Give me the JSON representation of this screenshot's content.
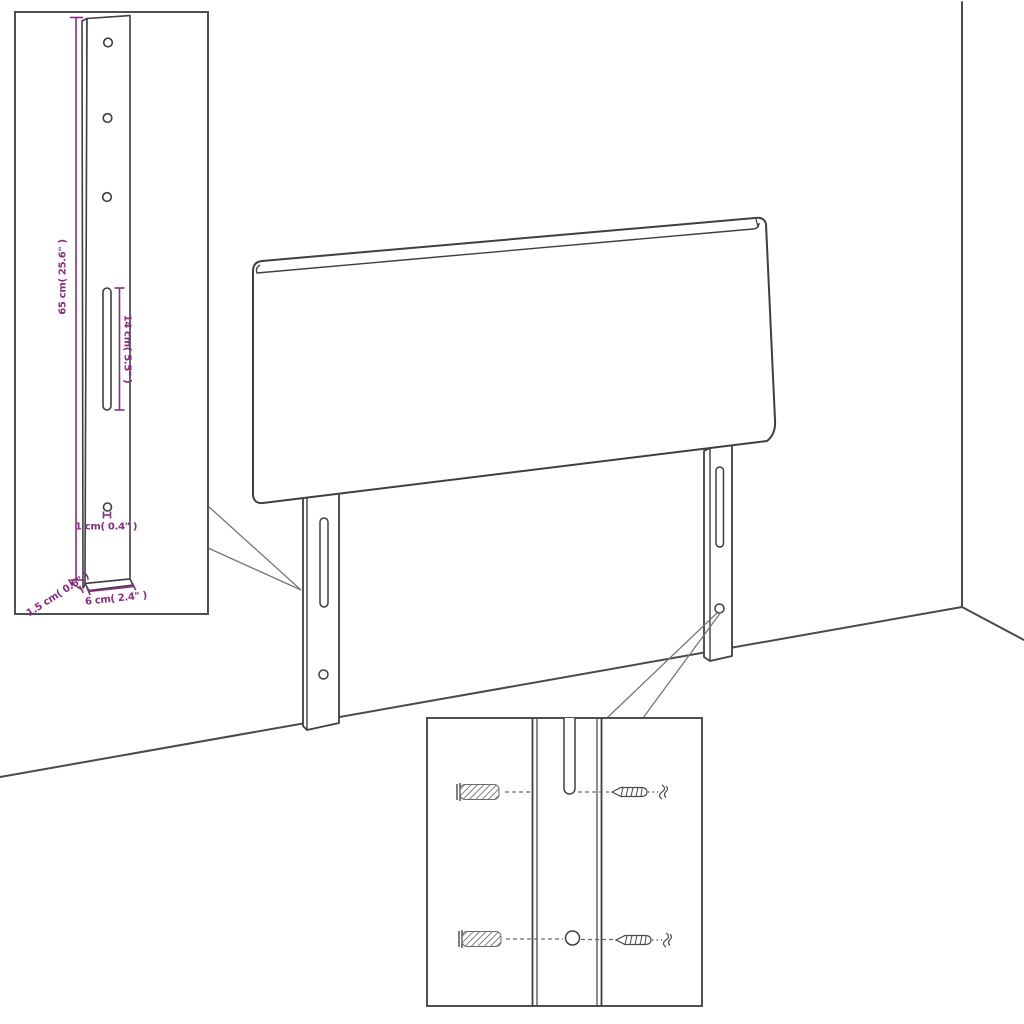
{
  "page": {
    "background": "#ffffff",
    "description": "Technical assembly diagram of an upholstered headboard with two slotted mounting legs shown in a room corner, with a zoomed leg-dimension inset and a wall-mounting hardware inset"
  },
  "colors": {
    "artwork_line": "#3f3f3f",
    "dimension": "#8a2d82",
    "inset_border": "#4f4f4f",
    "callout_line": "#777777",
    "background": "#ffffff"
  },
  "main_view": {
    "headboard": "upholstered headboard panel",
    "legs": 2,
    "leg_features": "each leg has one vertical slot and one round hole",
    "room": "wall corner line and floor lines"
  },
  "leg_inset": {
    "top_holes": 3,
    "height_label": "65 cm( 25.6\" )",
    "slot_label": "14 cm( 5.5\" )",
    "hole_label": "1 cm( 0.4\" )",
    "width_label": "6 cm( 2.4\" )",
    "depth_label": "1.5 cm( 0.6\" )"
  },
  "hardware_inset": {
    "wall_plugs": 2,
    "screws": 2,
    "rows": 2
  }
}
